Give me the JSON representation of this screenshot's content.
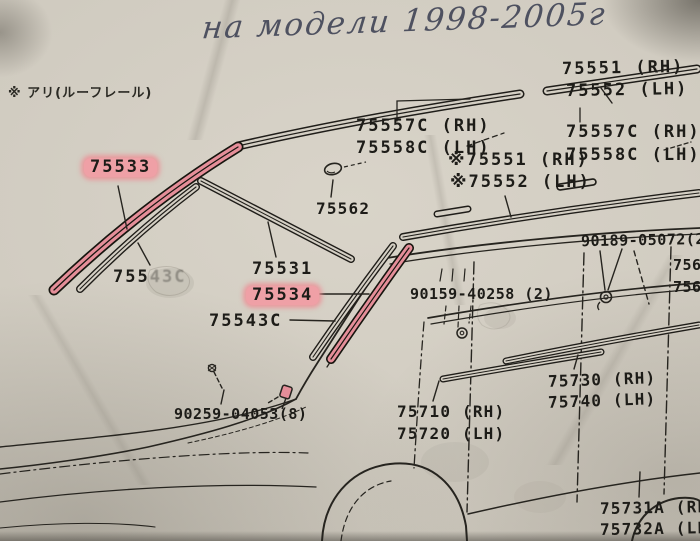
{
  "handwriting": {
    "text": "на модели 1998-2005г"
  },
  "notes": {
    "roof_rail": "※ アリ(ルーフレール)"
  },
  "colors": {
    "paper": "#cfcabf",
    "ink": "#1d1c18",
    "pencil": "#4e5160",
    "highlight": "#efa0a6",
    "highlight_strip": "#e58e99"
  },
  "part_labels": [
    {
      "id": "75551-rh-top",
      "text": "75551 (RH)",
      "highlighted": false
    },
    {
      "id": "75552-lh-top",
      "text": "75552 (LH)",
      "highlighted": false
    },
    {
      "id": "75557c-rh-left",
      "text": "75557C (RH)",
      "highlighted": false
    },
    {
      "id": "75558c-lh-left",
      "text": "75558C (LH)",
      "highlighted": false
    },
    {
      "id": "75557c-rh-right",
      "text": "75557C (RH)",
      "highlighted": false
    },
    {
      "id": "75558c-lh-right",
      "text": "75558C (LH)",
      "highlighted": false
    },
    {
      "id": "75551-rh-star",
      "text": "※75551 (RH)",
      "highlighted": false
    },
    {
      "id": "75552-lh-star",
      "text": "※75552 (LH)",
      "highlighted": false
    },
    {
      "id": "75533",
      "text": "75533",
      "highlighted": true
    },
    {
      "id": "75562",
      "text": "75562",
      "highlighted": false
    },
    {
      "id": "90189-05072",
      "text": "90189-05072(2)",
      "highlighted": false
    },
    {
      "id": "756-truncated-1",
      "text": "756",
      "highlighted": false
    },
    {
      "id": "756-truncated-2",
      "text": "756",
      "highlighted": false
    },
    {
      "id": "75531",
      "text": "75531",
      "highlighted": false
    },
    {
      "id": "75534",
      "text": "75534",
      "highlighted": true
    },
    {
      "id": "75543c",
      "text": "75543C",
      "highlighted": false
    },
    {
      "id": "75543c-faded",
      "text_strong": "755",
      "text_weak": "43C",
      "highlighted": false
    },
    {
      "id": "90159-40258",
      "text": "90159-40258 (2)",
      "highlighted": false
    },
    {
      "id": "75730-rh",
      "text": "75730 (RH)",
      "highlighted": false
    },
    {
      "id": "75740-lh",
      "text": "75740 (LH)",
      "highlighted": false
    },
    {
      "id": "75710-rh",
      "text": "75710 (RH)",
      "highlighted": false
    },
    {
      "id": "75720-lh",
      "text": "75720 (LH)",
      "highlighted": false
    },
    {
      "id": "90259-04053",
      "text": "90259-04053(8)",
      "highlighted": false
    },
    {
      "id": "75731a-rh",
      "text": "75731A (RH)",
      "highlighted": false
    },
    {
      "id": "75732a-lh",
      "text": "75732A (LH)",
      "highlighted": false
    }
  ]
}
